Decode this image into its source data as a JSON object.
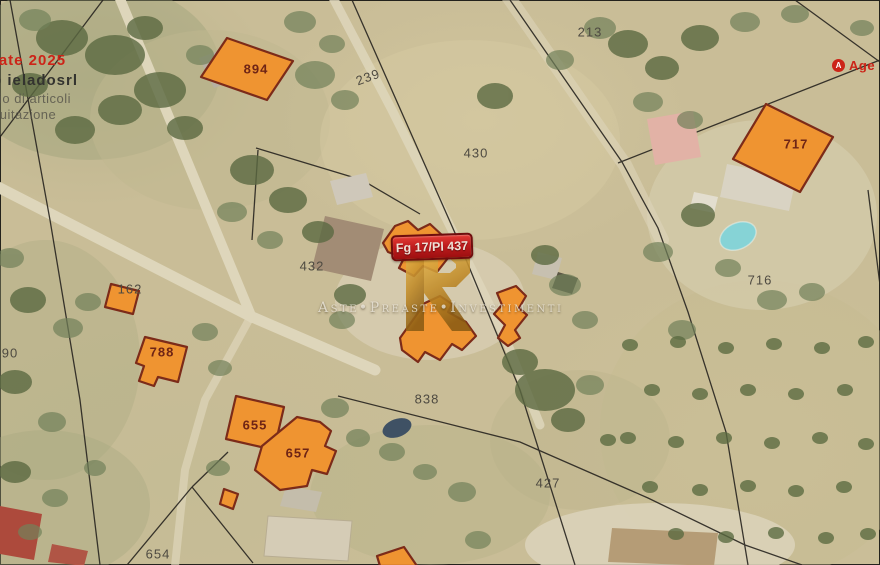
{
  "map": {
    "parcel_labels": [
      {
        "text": "894",
        "x": 256,
        "y": 69,
        "variant": "on-building"
      },
      {
        "text": "239",
        "x": 368,
        "y": 77,
        "variant": "ground",
        "rotate": -20
      },
      {
        "text": "213",
        "x": 590,
        "y": 32,
        "variant": "ground"
      },
      {
        "text": "430",
        "x": 476,
        "y": 153,
        "variant": "ground"
      },
      {
        "text": "717",
        "x": 796,
        "y": 144,
        "variant": "on-building"
      },
      {
        "text": "716",
        "x": 760,
        "y": 280,
        "variant": "ground"
      },
      {
        "text": "432",
        "x": 312,
        "y": 266,
        "variant": "ground"
      },
      {
        "text": "162",
        "x": 130,
        "y": 289,
        "variant": "ground"
      },
      {
        "text": "788",
        "x": 162,
        "y": 352,
        "variant": "on-building"
      },
      {
        "text": "90",
        "x": 10,
        "y": 353,
        "variant": "ground"
      },
      {
        "text": "655",
        "x": 255,
        "y": 425,
        "variant": "on-building"
      },
      {
        "text": "657",
        "x": 298,
        "y": 453,
        "variant": "on-building"
      },
      {
        "text": "838",
        "x": 427,
        "y": 399,
        "variant": "ground"
      },
      {
        "text": "427",
        "x": 548,
        "y": 483,
        "variant": "ground"
      },
      {
        "text": "654",
        "x": 158,
        "y": 554,
        "variant": "ground"
      }
    ],
    "subject_badge": {
      "text": "Fg 17/Pl 437"
    },
    "watermark": {
      "monogram": "PI",
      "wordmark": "Aste•Preaste•Investimenti"
    },
    "corner_watermark": {
      "line1": "rate 2025",
      "line2": "b ieladosrl",
      "line3": "zio di articoli",
      "line4": "guitazione"
    },
    "agency_badge": {
      "icon": "A",
      "text": "Age"
    },
    "colors": {
      "parcel_fill": "#ef9431",
      "parcel_stroke": "#7c2b19",
      "badge_red": "#c01d1e",
      "watermark_gold": "#c9952f",
      "boundary_line": "#27241f"
    }
  }
}
